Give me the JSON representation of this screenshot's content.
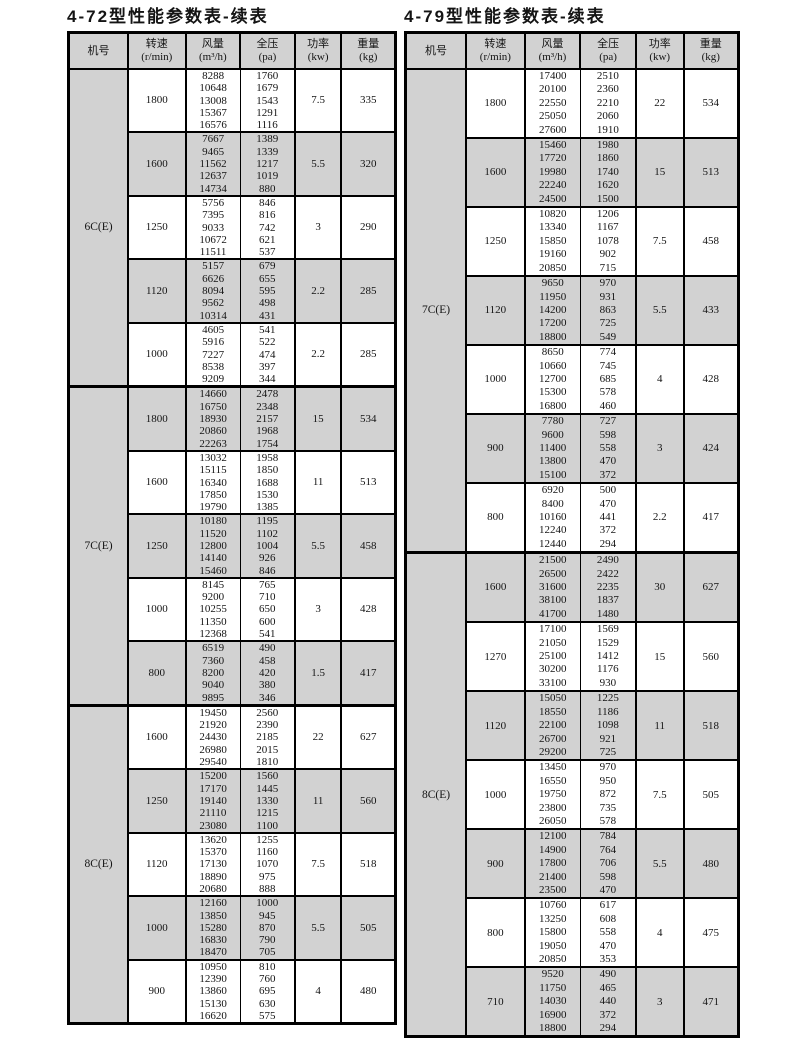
{
  "colors": {
    "shaded": "#d2d2d2",
    "border": "#000000",
    "text": "#141414",
    "page_bg": "#ffffff"
  },
  "tables": [
    {
      "title": "4-72型性能参数表-续表",
      "headers": [
        {
          "key": "model",
          "name": "机号",
          "unit": ""
        },
        {
          "key": "speed",
          "name": "转速",
          "unit": "(r/min)"
        },
        {
          "key": "flow",
          "name": "风量",
          "unit": "(m³/h)"
        },
        {
          "key": "pressure",
          "name": "全压",
          "unit": "(pa)"
        },
        {
          "key": "power",
          "name": "功率",
          "unit": "(kw)"
        },
        {
          "key": "weight",
          "name": "重量",
          "unit": "(kg)"
        }
      ],
      "machines": [
        {
          "model": "6C(E)",
          "groups": [
            {
              "speed": "1800",
              "flow": [
                8288,
                10648,
                13008,
                15367,
                16576
              ],
              "pressure": [
                1760,
                1679,
                1543,
                1291,
                1116
              ],
              "power": "7.5",
              "weight": "335",
              "shaded": false
            },
            {
              "speed": "1600",
              "flow": [
                7667,
                9465,
                11562,
                12637,
                14734
              ],
              "pressure": [
                1389,
                1339,
                1217,
                1019,
                880
              ],
              "power": "5.5",
              "weight": "320",
              "shaded": true
            },
            {
              "speed": "1250",
              "flow": [
                5756,
                7395,
                9033,
                10672,
                11511
              ],
              "pressure": [
                846,
                816,
                742,
                621,
                537
              ],
              "power": "3",
              "weight": "290",
              "shaded": false
            },
            {
              "speed": "1120",
              "flow": [
                5157,
                6626,
                8094,
                9562,
                10314
              ],
              "pressure": [
                679,
                655,
                595,
                498,
                431
              ],
              "power": "2.2",
              "weight": "285",
              "shaded": true
            },
            {
              "speed": "1000",
              "flow": [
                4605,
                5916,
                7227,
                8538,
                9209
              ],
              "pressure": [
                541,
                522,
                474,
                397,
                344
              ],
              "power": "2.2",
              "weight": "285",
              "shaded": false
            }
          ]
        },
        {
          "model": "7C(E)",
          "groups": [
            {
              "speed": "1800",
              "flow": [
                14660,
                16750,
                18930,
                20860,
                22263
              ],
              "pressure": [
                2478,
                2348,
                2157,
                1968,
                1754
              ],
              "power": "15",
              "weight": "534",
              "shaded": true
            },
            {
              "speed": "1600",
              "flow": [
                13032,
                15115,
                16340,
                17850,
                19790
              ],
              "pressure": [
                1958,
                1850,
                1688,
                1530,
                1385
              ],
              "power": "11",
              "weight": "513",
              "shaded": false
            },
            {
              "speed": "1250",
              "flow": [
                10180,
                11520,
                12800,
                14140,
                15460
              ],
              "pressure": [
                1195,
                1102,
                1004,
                926,
                846
              ],
              "power": "5.5",
              "weight": "458",
              "shaded": true
            },
            {
              "speed": "1000",
              "flow": [
                8145,
                9200,
                10255,
                11350,
                12368
              ],
              "pressure": [
                765,
                710,
                650,
                600,
                541
              ],
              "power": "3",
              "weight": "428",
              "shaded": false
            },
            {
              "speed": "800",
              "flow": [
                6519,
                7360,
                8200,
                9040,
                9895
              ],
              "pressure": [
                490,
                458,
                420,
                380,
                346
              ],
              "power": "1.5",
              "weight": "417",
              "shaded": true
            }
          ]
        },
        {
          "model": "8C(E)",
          "groups": [
            {
              "speed": "1600",
              "flow": [
                19450,
                21920,
                24430,
                26980,
                29540
              ],
              "pressure": [
                2560,
                2390,
                2185,
                2015,
                1810
              ],
              "power": "22",
              "weight": "627",
              "shaded": false
            },
            {
              "speed": "1250",
              "flow": [
                15200,
                17170,
                19140,
                21110,
                23080
              ],
              "pressure": [
                1560,
                1445,
                1330,
                1215,
                1100
              ],
              "power": "11",
              "weight": "560",
              "shaded": true
            },
            {
              "speed": "1120",
              "flow": [
                13620,
                15370,
                17130,
                18890,
                20680
              ],
              "pressure": [
                1255,
                1160,
                1070,
                975,
                888
              ],
              "power": "7.5",
              "weight": "518",
              "shaded": false
            },
            {
              "speed": "1000",
              "flow": [
                12160,
                13850,
                15280,
                16830,
                18470
              ],
              "pressure": [
                1000,
                945,
                870,
                790,
                705
              ],
              "power": "5.5",
              "weight": "505",
              "shaded": true
            },
            {
              "speed": "900",
              "flow": [
                10950,
                12390,
                13860,
                15130,
                16620
              ],
              "pressure": [
                810,
                760,
                695,
                630,
                575
              ],
              "power": "4",
              "weight": "480",
              "shaded": false
            }
          ]
        }
      ]
    },
    {
      "title": "4-79型性能参数表-续表",
      "headers": [
        {
          "key": "model",
          "name": "机号",
          "unit": ""
        },
        {
          "key": "speed",
          "name": "转速",
          "unit": "(r/min)"
        },
        {
          "key": "flow",
          "name": "风量",
          "unit": "(m³/h)"
        },
        {
          "key": "pressure",
          "name": "全压",
          "unit": "(pa)"
        },
        {
          "key": "power",
          "name": "功率",
          "unit": "(kw)"
        },
        {
          "key": "weight",
          "name": "重量",
          "unit": "(kg)"
        }
      ],
      "machines": [
        {
          "model": "7C(E)",
          "groups": [
            {
              "speed": "1800",
              "flow": [
                17400,
                20100,
                22550,
                25050,
                27600
              ],
              "pressure": [
                2510,
                2360,
                2210,
                2060,
                1910
              ],
              "power": "22",
              "weight": "534",
              "shaded": false
            },
            {
              "speed": "1600",
              "flow": [
                15460,
                17720,
                19980,
                22240,
                24500
              ],
              "pressure": [
                1980,
                1860,
                1740,
                1620,
                1500
              ],
              "power": "15",
              "weight": "513",
              "shaded": true
            },
            {
              "speed": "1250",
              "flow": [
                10820,
                13340,
                15850,
                19160,
                20850
              ],
              "pressure": [
                1206,
                1167,
                1078,
                902,
                715
              ],
              "power": "7.5",
              "weight": "458",
              "shaded": false
            },
            {
              "speed": "1120",
              "flow": [
                9650,
                11950,
                14200,
                17200,
                18800
              ],
              "pressure": [
                970,
                931,
                863,
                725,
                549
              ],
              "power": "5.5",
              "weight": "433",
              "shaded": true
            },
            {
              "speed": "1000",
              "flow": [
                8650,
                10660,
                12700,
                15300,
                16800
              ],
              "pressure": [
                774,
                745,
                685,
                578,
                460
              ],
              "power": "4",
              "weight": "428",
              "shaded": false
            },
            {
              "speed": "900",
              "flow": [
                7780,
                9600,
                11400,
                13800,
                15100
              ],
              "pressure": [
                727,
                598,
                558,
                470,
                372
              ],
              "power": "3",
              "weight": "424",
              "shaded": true
            },
            {
              "speed": "800",
              "flow": [
                6920,
                8400,
                10160,
                12240,
                12440
              ],
              "pressure": [
                500,
                470,
                441,
                372,
                294
              ],
              "power": "2.2",
              "weight": "417",
              "shaded": false
            }
          ]
        },
        {
          "model": "8C(E)",
          "groups": [
            {
              "speed": "1600",
              "flow": [
                21500,
                26500,
                31600,
                38100,
                41700
              ],
              "pressure": [
                2490,
                2422,
                2235,
                1837,
                1480
              ],
              "power": "30",
              "weight": "627",
              "shaded": true
            },
            {
              "speed": "1270",
              "flow": [
                17100,
                21050,
                25100,
                30200,
                33100
              ],
              "pressure": [
                1569,
                1529,
                1412,
                1176,
                930
              ],
              "power": "15",
              "weight": "560",
              "shaded": false
            },
            {
              "speed": "1120",
              "flow": [
                15050,
                18550,
                22100,
                26700,
                29200
              ],
              "pressure": [
                1225,
                1186,
                1098,
                921,
                725
              ],
              "power": "11",
              "weight": "518",
              "shaded": true
            },
            {
              "speed": "1000",
              "flow": [
                13450,
                16550,
                19750,
                23800,
                26050
              ],
              "pressure": [
                970,
                950,
                872,
                735,
                578
              ],
              "power": "7.5",
              "weight": "505",
              "shaded": false
            },
            {
              "speed": "900",
              "flow": [
                12100,
                14900,
                17800,
                21400,
                23500
              ],
              "pressure": [
                784,
                764,
                706,
                598,
                470
              ],
              "power": "5.5",
              "weight": "480",
              "shaded": true
            },
            {
              "speed": "800",
              "flow": [
                10760,
                13250,
                15800,
                19050,
                20850
              ],
              "pressure": [
                617,
                608,
                558,
                470,
                353
              ],
              "power": "4",
              "weight": "475",
              "shaded": false
            },
            {
              "speed": "710",
              "flow": [
                9520,
                11750,
                14030,
                16900,
                18800
              ],
              "pressure": [
                490,
                465,
                440,
                372,
                294
              ],
              "power": "3",
              "weight": "471",
              "shaded": true
            }
          ]
        }
      ]
    }
  ]
}
